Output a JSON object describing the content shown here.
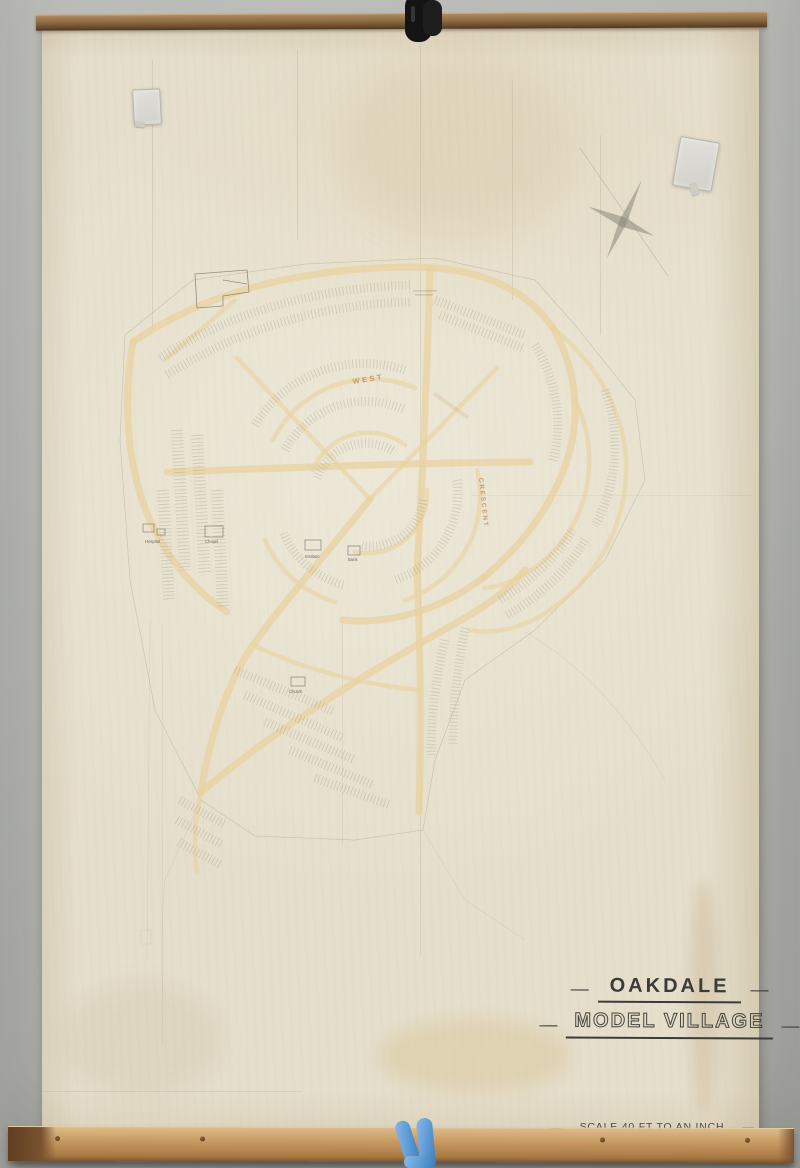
{
  "wall_map": {
    "title_line1": "OAKDALE",
    "title_line2": "MODEL VILLAGE",
    "scale_label": "SCALE 40 FT TO AN INCH",
    "dash": "—",
    "street_labels": {
      "west": "WEST",
      "crescent": "CRESCENT"
    },
    "building_labels": {
      "hospital": "Hospital",
      "chapel": "Chapel",
      "institute": "Institute",
      "bank": "Bank",
      "church": "Church"
    },
    "colors": {
      "wall": "#b1b2ae",
      "paper": "#e5decb",
      "road_tint": "#ead29f",
      "plot_ink": "#8f8878",
      "title_ink": "#3b3b37",
      "wood_top": "#8d6c44",
      "wood_bottom": "#c89a62",
      "glove_blue": "#5d9ad3"
    }
  }
}
